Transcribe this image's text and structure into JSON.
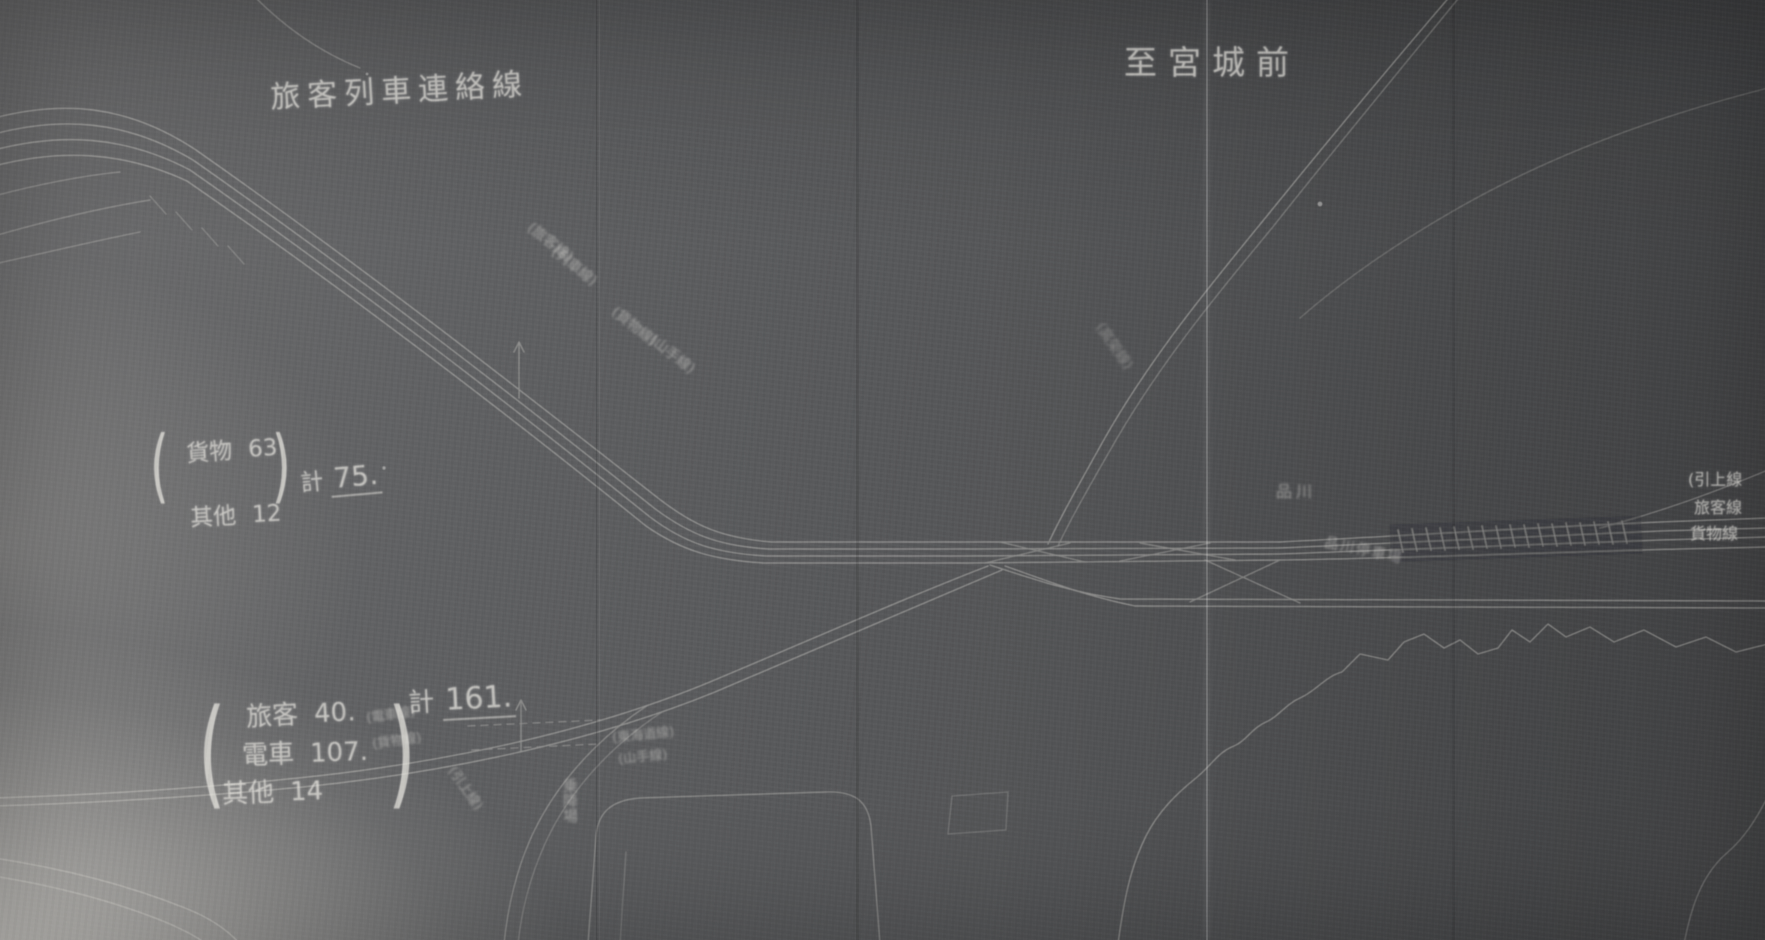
{
  "meta": {
    "description": "Photograph of a hand-drawn railway track planning diagram (dark blueprint style) with Japanese chalk-like annotations",
    "chalk_color": "#eceae4",
    "track_line_color": "#dcdad4",
    "background_color": "#565759"
  },
  "labels": {
    "title_left": "旅客列車連絡線",
    "destination_top_right": "至宮城前",
    "station_right": "品川",
    "station_right_2": "品川停車場",
    "bottom_center": "乗降場"
  },
  "chars": {
    "paren_open": "(",
    "paren_close": ")"
  },
  "count_group_upper": {
    "rows": [
      {
        "label": "貨物",
        "value": "63"
      },
      {
        "label": "其他",
        "value": "12"
      }
    ],
    "total_label": "計",
    "total_value": "75."
  },
  "count_group_lower": {
    "rows": [
      {
        "label": "旅客",
        "value": "40."
      },
      {
        "label": "電車",
        "value": "107."
      },
      {
        "label": "其他",
        "value": "14"
      }
    ],
    "total_label": "計",
    "total_value": "161."
  },
  "annotations": {
    "diagonal_upper_row1": "(旅客線)",
    "diagonal_upper_row2": "(列車線)",
    "diagonal_mid_row1": "(貨物線)",
    "diagonal_mid_row2": "(山手線)",
    "curve_right": "(高架線)",
    "lower_route_row1": "(電車線)",
    "lower_route_row2": "(貨物線)",
    "lower_right_row1": "(東海道線)",
    "lower_right_row2": "(山手線)",
    "steep_branch": "(引上線)",
    "right_edge_rows": [
      "(引上線",
      "旅客線",
      "貨物線"
    ]
  }
}
